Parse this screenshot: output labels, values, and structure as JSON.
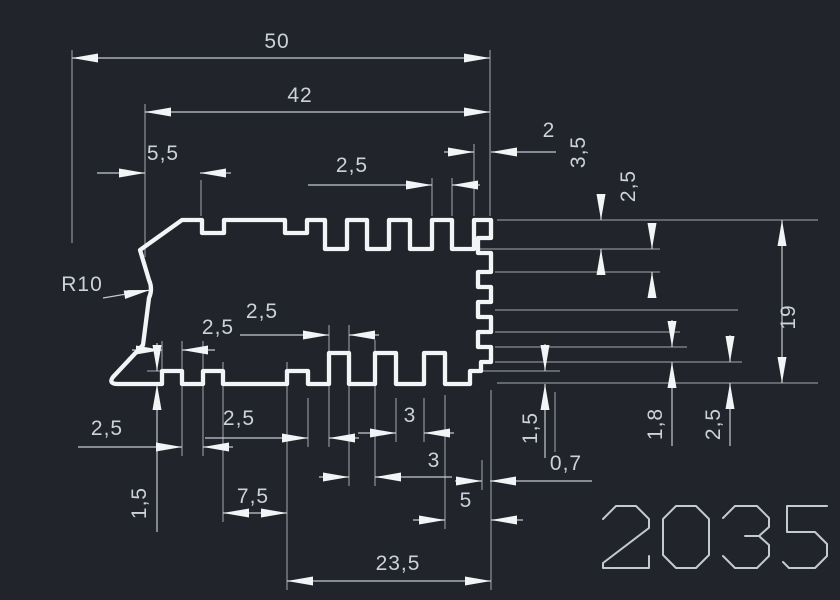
{
  "canvas": {
    "background": "#21252b",
    "profile_line_color": "#f2f4f6",
    "dimension_line_color": "#c4cad1",
    "text_color": "#ccd2d9"
  },
  "drawing": {
    "part_number": "2035",
    "dimensions": {
      "d50": "50",
      "d42": "42",
      "d5_5": "5,5",
      "d2_5_top": "2,5",
      "d2": "2",
      "d3_5": "3,5",
      "d2_5_right_upper": "2,5",
      "d19": "19",
      "r10": "R10",
      "d2_5_a": "2,5",
      "d2_5_b": "2,5",
      "d2_5_left": "2,5",
      "d2_5_mid": "2,5",
      "d3_a": "3",
      "d3_b": "3",
      "d1_5_left": "1,5",
      "d7_5": "7,5",
      "d5": "5",
      "d23_5": "23,5",
      "d1_5_right": "1,5",
      "d0_7": "0,7",
      "d1_8": "1,8",
      "d2_5_right_lower": "2,5"
    }
  }
}
